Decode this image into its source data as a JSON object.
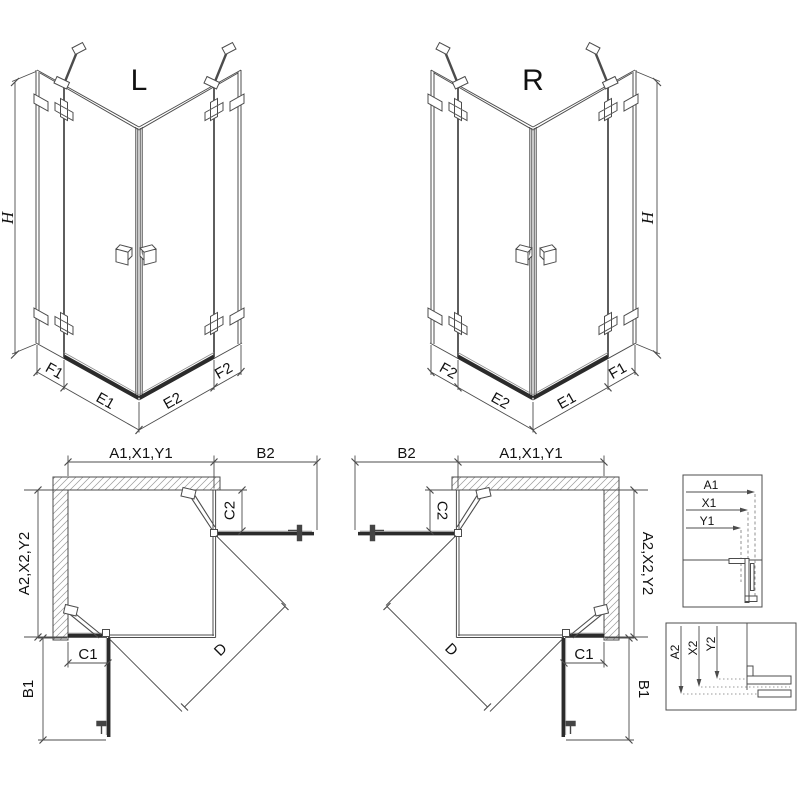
{
  "colors": {
    "line": "#4c4c4c",
    "dark_profile": "#2b2b2b",
    "hatch": "#999999",
    "text": "#111111",
    "background": "#ffffff"
  },
  "iso": {
    "left_label": "L",
    "right_label": "R",
    "height_dim": "H",
    "dims": {
      "f1": "F1",
      "e1": "E1",
      "e2": "E2",
      "f2": "F2"
    }
  },
  "plan": {
    "width_dim": "A1,X1,Y1",
    "entry_top_dim": "B2",
    "depth_dim": "A2,X2,Y2",
    "fixed_top_dim": "C2",
    "fixed_bottom_dim": "C1",
    "entry_bottom_dim": "B1",
    "diagonal_dim": "D"
  },
  "detail_width": {
    "a": "A1",
    "x": "X1",
    "y": "Y1"
  },
  "detail_depth": {
    "a": "A2",
    "x": "X2",
    "y": "Y2"
  }
}
